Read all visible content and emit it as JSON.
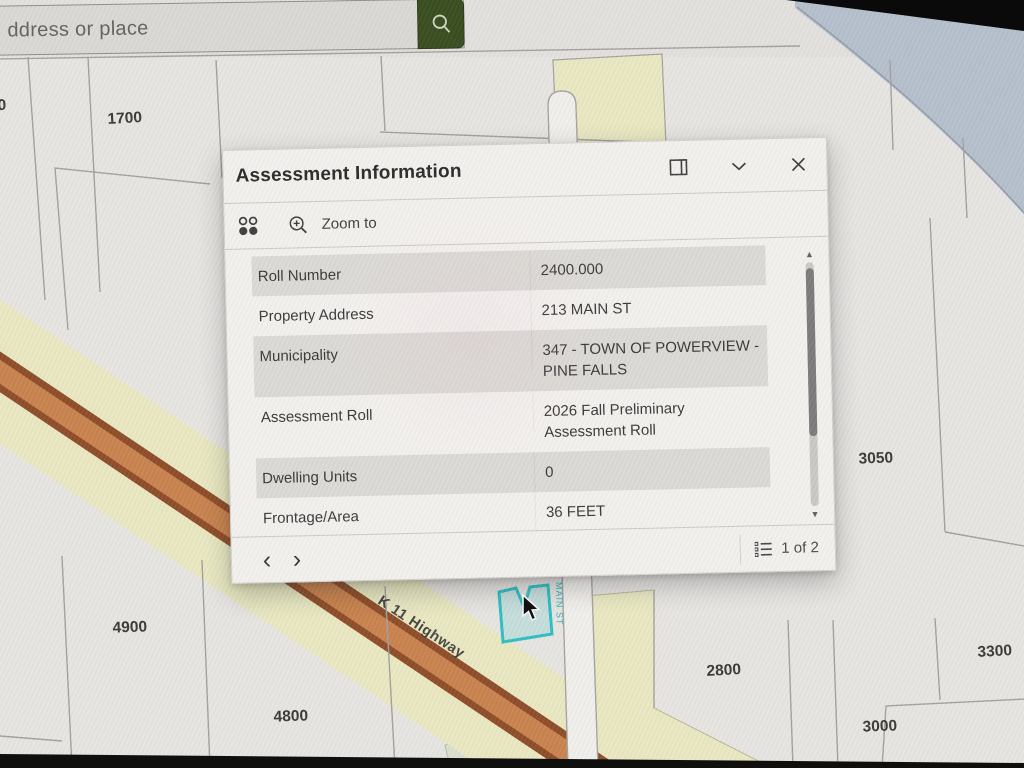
{
  "search": {
    "placeholder": "ddress or place"
  },
  "panel": {
    "title": "Assessment Information",
    "toolbar": {
      "zoom_to": "Zoom to"
    },
    "rows": [
      {
        "label": "Roll Number",
        "value": "2400.000"
      },
      {
        "label": "Property Address",
        "value": "213 MAIN ST"
      },
      {
        "label": "Municipality",
        "value": "347 - TOWN OF POWERVIEW - PINE FALLS"
      },
      {
        "label": "Assessment Roll",
        "value": "2026 Fall Preliminary Assessment Roll"
      },
      {
        "label": "Dwelling Units",
        "value": "0"
      },
      {
        "label": "Frontage/Area",
        "value": "36 FEET"
      }
    ],
    "footer": {
      "prev": "‹",
      "next": "›",
      "page_label": "1 of 2"
    },
    "scrollbar": {
      "up": "▲",
      "down": "▼"
    }
  },
  "map": {
    "labels": [
      {
        "text": "0"
      },
      {
        "text": "1700"
      },
      {
        "text": "3050"
      },
      {
        "text": "4900"
      },
      {
        "text": "4800"
      },
      {
        "text": "2800"
      },
      {
        "text": "3300"
      },
      {
        "text": "3000"
      }
    ],
    "road_label": "K 11 Highway",
    "street_label": "MAIN ST",
    "colors": {
      "parcel": "#e7e5e2",
      "line": "#a3a29f",
      "water": "#b5c0cd",
      "cream": "#e9e8c2",
      "highway_orange": "#c9834f",
      "highway_edge": "#8f4e2a",
      "road_fill": "#f0efec",
      "selection_stroke": "#2fbfc4"
    }
  }
}
